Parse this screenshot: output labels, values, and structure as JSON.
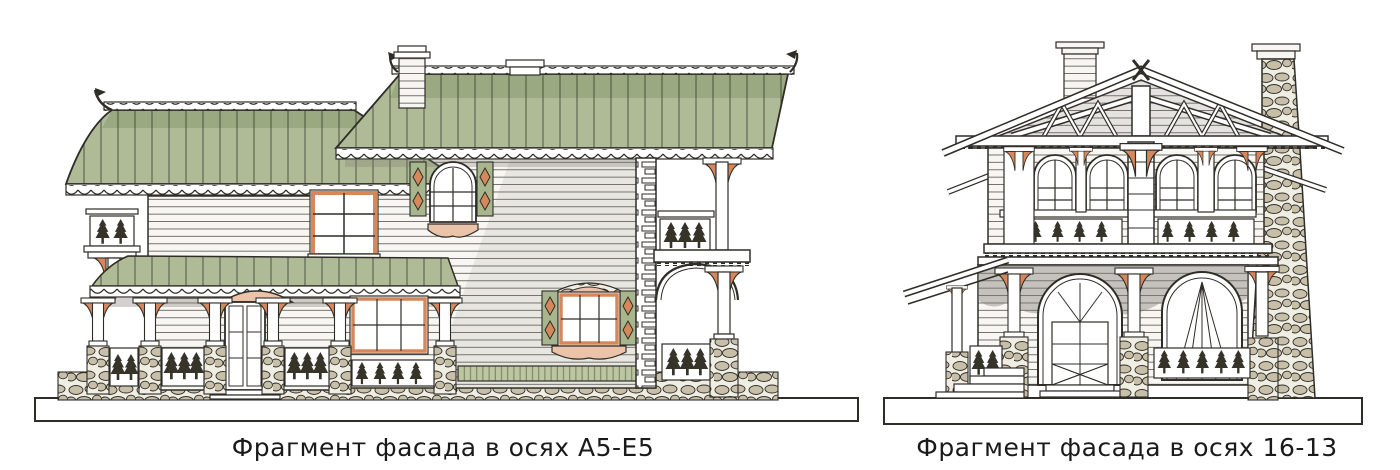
{
  "figures": [
    {
      "id": "left-facade",
      "caption": "Фрагмент фасада в осях А5-Е5"
    },
    {
      "id": "right-facade",
      "caption": "Фрагмент фасада в осях 16-13"
    }
  ],
  "colors": {
    "paper": "#ffffff",
    "line": "#2f2d28",
    "wall": "#f7f6f2",
    "roof": "#afbb97",
    "roof_dark": "#85976b",
    "accent": "#d6885c",
    "blush": "#eac3a9",
    "stone": "#c7bfa8",
    "stone_joint": "#f0ede3",
    "shutter": "#a8b68d",
    "lattice": "#bcc6a1",
    "tree": "#363329",
    "shadow": "#7e7a72",
    "caption": "#1a1a1a"
  }
}
